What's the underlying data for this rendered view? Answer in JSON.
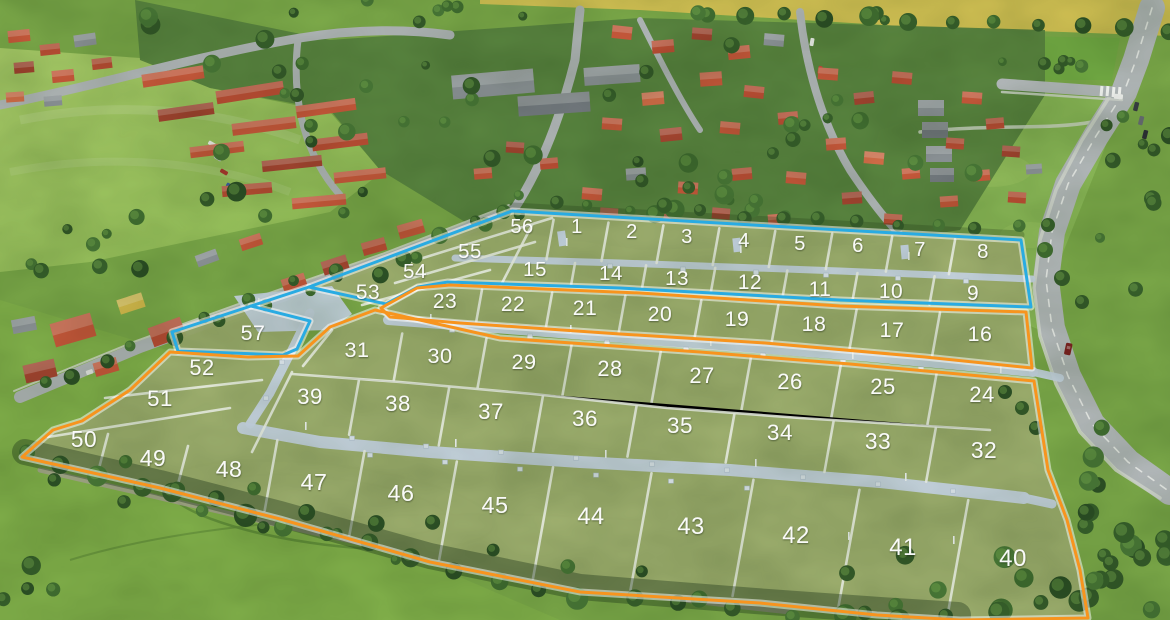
{
  "page": {
    "type": "aerial-development-lot-map"
  },
  "label_color": "#ffffff",
  "zones": [
    {
      "id": "blue",
      "color": "#29abe2",
      "lots_range": "1-15, 53-57"
    },
    {
      "id": "orange",
      "color": "#f7941e",
      "lots_range": "16-52"
    }
  ],
  "lots": [
    {
      "n": "1",
      "x": 577,
      "y": 227,
      "zone": "blue"
    },
    {
      "n": "2",
      "x": 632,
      "y": 232,
      "zone": "blue"
    },
    {
      "n": "3",
      "x": 687,
      "y": 237,
      "zone": "blue"
    },
    {
      "n": "4",
      "x": 744,
      "y": 241,
      "zone": "blue"
    },
    {
      "n": "5",
      "x": 800,
      "y": 244,
      "zone": "blue"
    },
    {
      "n": "6",
      "x": 858,
      "y": 246,
      "zone": "blue"
    },
    {
      "n": "7",
      "x": 920,
      "y": 250,
      "zone": "blue"
    },
    {
      "n": "8",
      "x": 983,
      "y": 252,
      "zone": "blue"
    },
    {
      "n": "9",
      "x": 973,
      "y": 294,
      "zone": "blue"
    },
    {
      "n": "10",
      "x": 891,
      "y": 292,
      "zone": "blue"
    },
    {
      "n": "11",
      "x": 820,
      "y": 290,
      "zone": "blue"
    },
    {
      "n": "12",
      "x": 750,
      "y": 283,
      "zone": "blue"
    },
    {
      "n": "13",
      "x": 677,
      "y": 279,
      "zone": "blue"
    },
    {
      "n": "14",
      "x": 611,
      "y": 274,
      "zone": "blue"
    },
    {
      "n": "15",
      "x": 535,
      "y": 270,
      "zone": "blue"
    },
    {
      "n": "16",
      "x": 980,
      "y": 335,
      "zone": "orange"
    },
    {
      "n": "17",
      "x": 892,
      "y": 331,
      "zone": "orange"
    },
    {
      "n": "18",
      "x": 814,
      "y": 325,
      "zone": "orange"
    },
    {
      "n": "19",
      "x": 737,
      "y": 320,
      "zone": "orange"
    },
    {
      "n": "20",
      "x": 660,
      "y": 315,
      "zone": "orange"
    },
    {
      "n": "21",
      "x": 585,
      "y": 309,
      "zone": "orange"
    },
    {
      "n": "22",
      "x": 513,
      "y": 305,
      "zone": "orange"
    },
    {
      "n": "23",
      "x": 445,
      "y": 302,
      "zone": "orange"
    },
    {
      "n": "24",
      "x": 982,
      "y": 396,
      "zone": "orange"
    },
    {
      "n": "25",
      "x": 883,
      "y": 388,
      "zone": "orange"
    },
    {
      "n": "26",
      "x": 790,
      "y": 383,
      "zone": "orange"
    },
    {
      "n": "27",
      "x": 702,
      "y": 377,
      "zone": "orange"
    },
    {
      "n": "28",
      "x": 610,
      "y": 370,
      "zone": "orange"
    },
    {
      "n": "29",
      "x": 524,
      "y": 363,
      "zone": "orange"
    },
    {
      "n": "30",
      "x": 440,
      "y": 357,
      "zone": "orange"
    },
    {
      "n": "31",
      "x": 357,
      "y": 351,
      "zone": "orange"
    },
    {
      "n": "32",
      "x": 984,
      "y": 452,
      "zone": "orange"
    },
    {
      "n": "33",
      "x": 878,
      "y": 443,
      "zone": "orange"
    },
    {
      "n": "34",
      "x": 780,
      "y": 434,
      "zone": "orange"
    },
    {
      "n": "35",
      "x": 680,
      "y": 427,
      "zone": "orange"
    },
    {
      "n": "36",
      "x": 585,
      "y": 420,
      "zone": "orange"
    },
    {
      "n": "37",
      "x": 491,
      "y": 413,
      "zone": "orange"
    },
    {
      "n": "38",
      "x": 398,
      "y": 405,
      "zone": "orange"
    },
    {
      "n": "39",
      "x": 310,
      "y": 398,
      "zone": "orange"
    },
    {
      "n": "40",
      "x": 1013,
      "y": 560,
      "zone": "orange"
    },
    {
      "n": "41",
      "x": 903,
      "y": 549,
      "zone": "orange"
    },
    {
      "n": "42",
      "x": 796,
      "y": 537,
      "zone": "orange"
    },
    {
      "n": "43",
      "x": 691,
      "y": 528,
      "zone": "orange"
    },
    {
      "n": "44",
      "x": 591,
      "y": 518,
      "zone": "orange"
    },
    {
      "n": "45",
      "x": 495,
      "y": 507,
      "zone": "orange"
    },
    {
      "n": "46",
      "x": 401,
      "y": 495,
      "zone": "orange"
    },
    {
      "n": "47",
      "x": 314,
      "y": 484,
      "zone": "orange"
    },
    {
      "n": "48",
      "x": 229,
      "y": 471,
      "zone": "orange"
    },
    {
      "n": "49",
      "x": 153,
      "y": 460,
      "zone": "orange"
    },
    {
      "n": "50",
      "x": 84,
      "y": 441,
      "zone": "orange"
    },
    {
      "n": "51",
      "x": 160,
      "y": 400,
      "zone": "orange"
    },
    {
      "n": "52",
      "x": 202,
      "y": 369,
      "zone": "orange"
    },
    {
      "n": "53",
      "x": 368,
      "y": 293,
      "zone": "blue"
    },
    {
      "n": "54",
      "x": 415,
      "y": 272,
      "zone": "blue"
    },
    {
      "n": "55",
      "x": 470,
      "y": 252,
      "zone": "blue"
    },
    {
      "n": "56",
      "x": 522,
      "y": 227,
      "zone": "blue"
    },
    {
      "n": "57",
      "x": 253,
      "y": 334,
      "zone": "blue"
    }
  ]
}
